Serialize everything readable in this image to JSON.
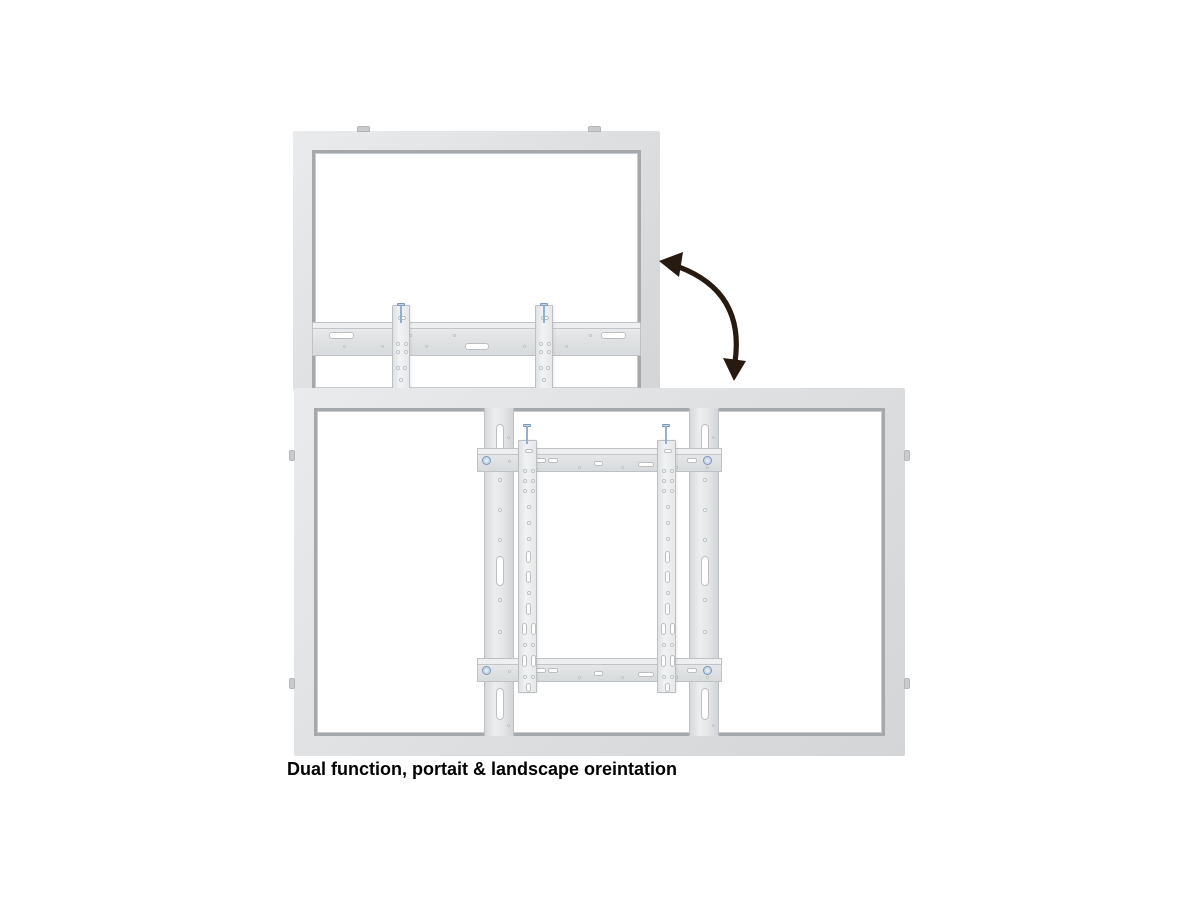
{
  "caption": {
    "text": "Dual function, portait & landscape oreintation"
  },
  "icons": {
    "rotation_arrow": "curved-double-headed-arrow"
  },
  "colors": {
    "background": "#ffffff",
    "frame_fill": "#dcdee0",
    "frame_fill_light": "#e9ebed",
    "frame_edge": "#a6a9ab",
    "frame_edge_light": "#c9ccce",
    "part_edge": "#bfc2c4",
    "hole_fill": "#ffffff",
    "hole_edge": "#bcbfc1",
    "screw_fill": "#93aed0",
    "screw_edge": "#7b97ba",
    "bolt_fill": "#e8edf4",
    "arrow": "#271a11",
    "text": "#000000"
  }
}
